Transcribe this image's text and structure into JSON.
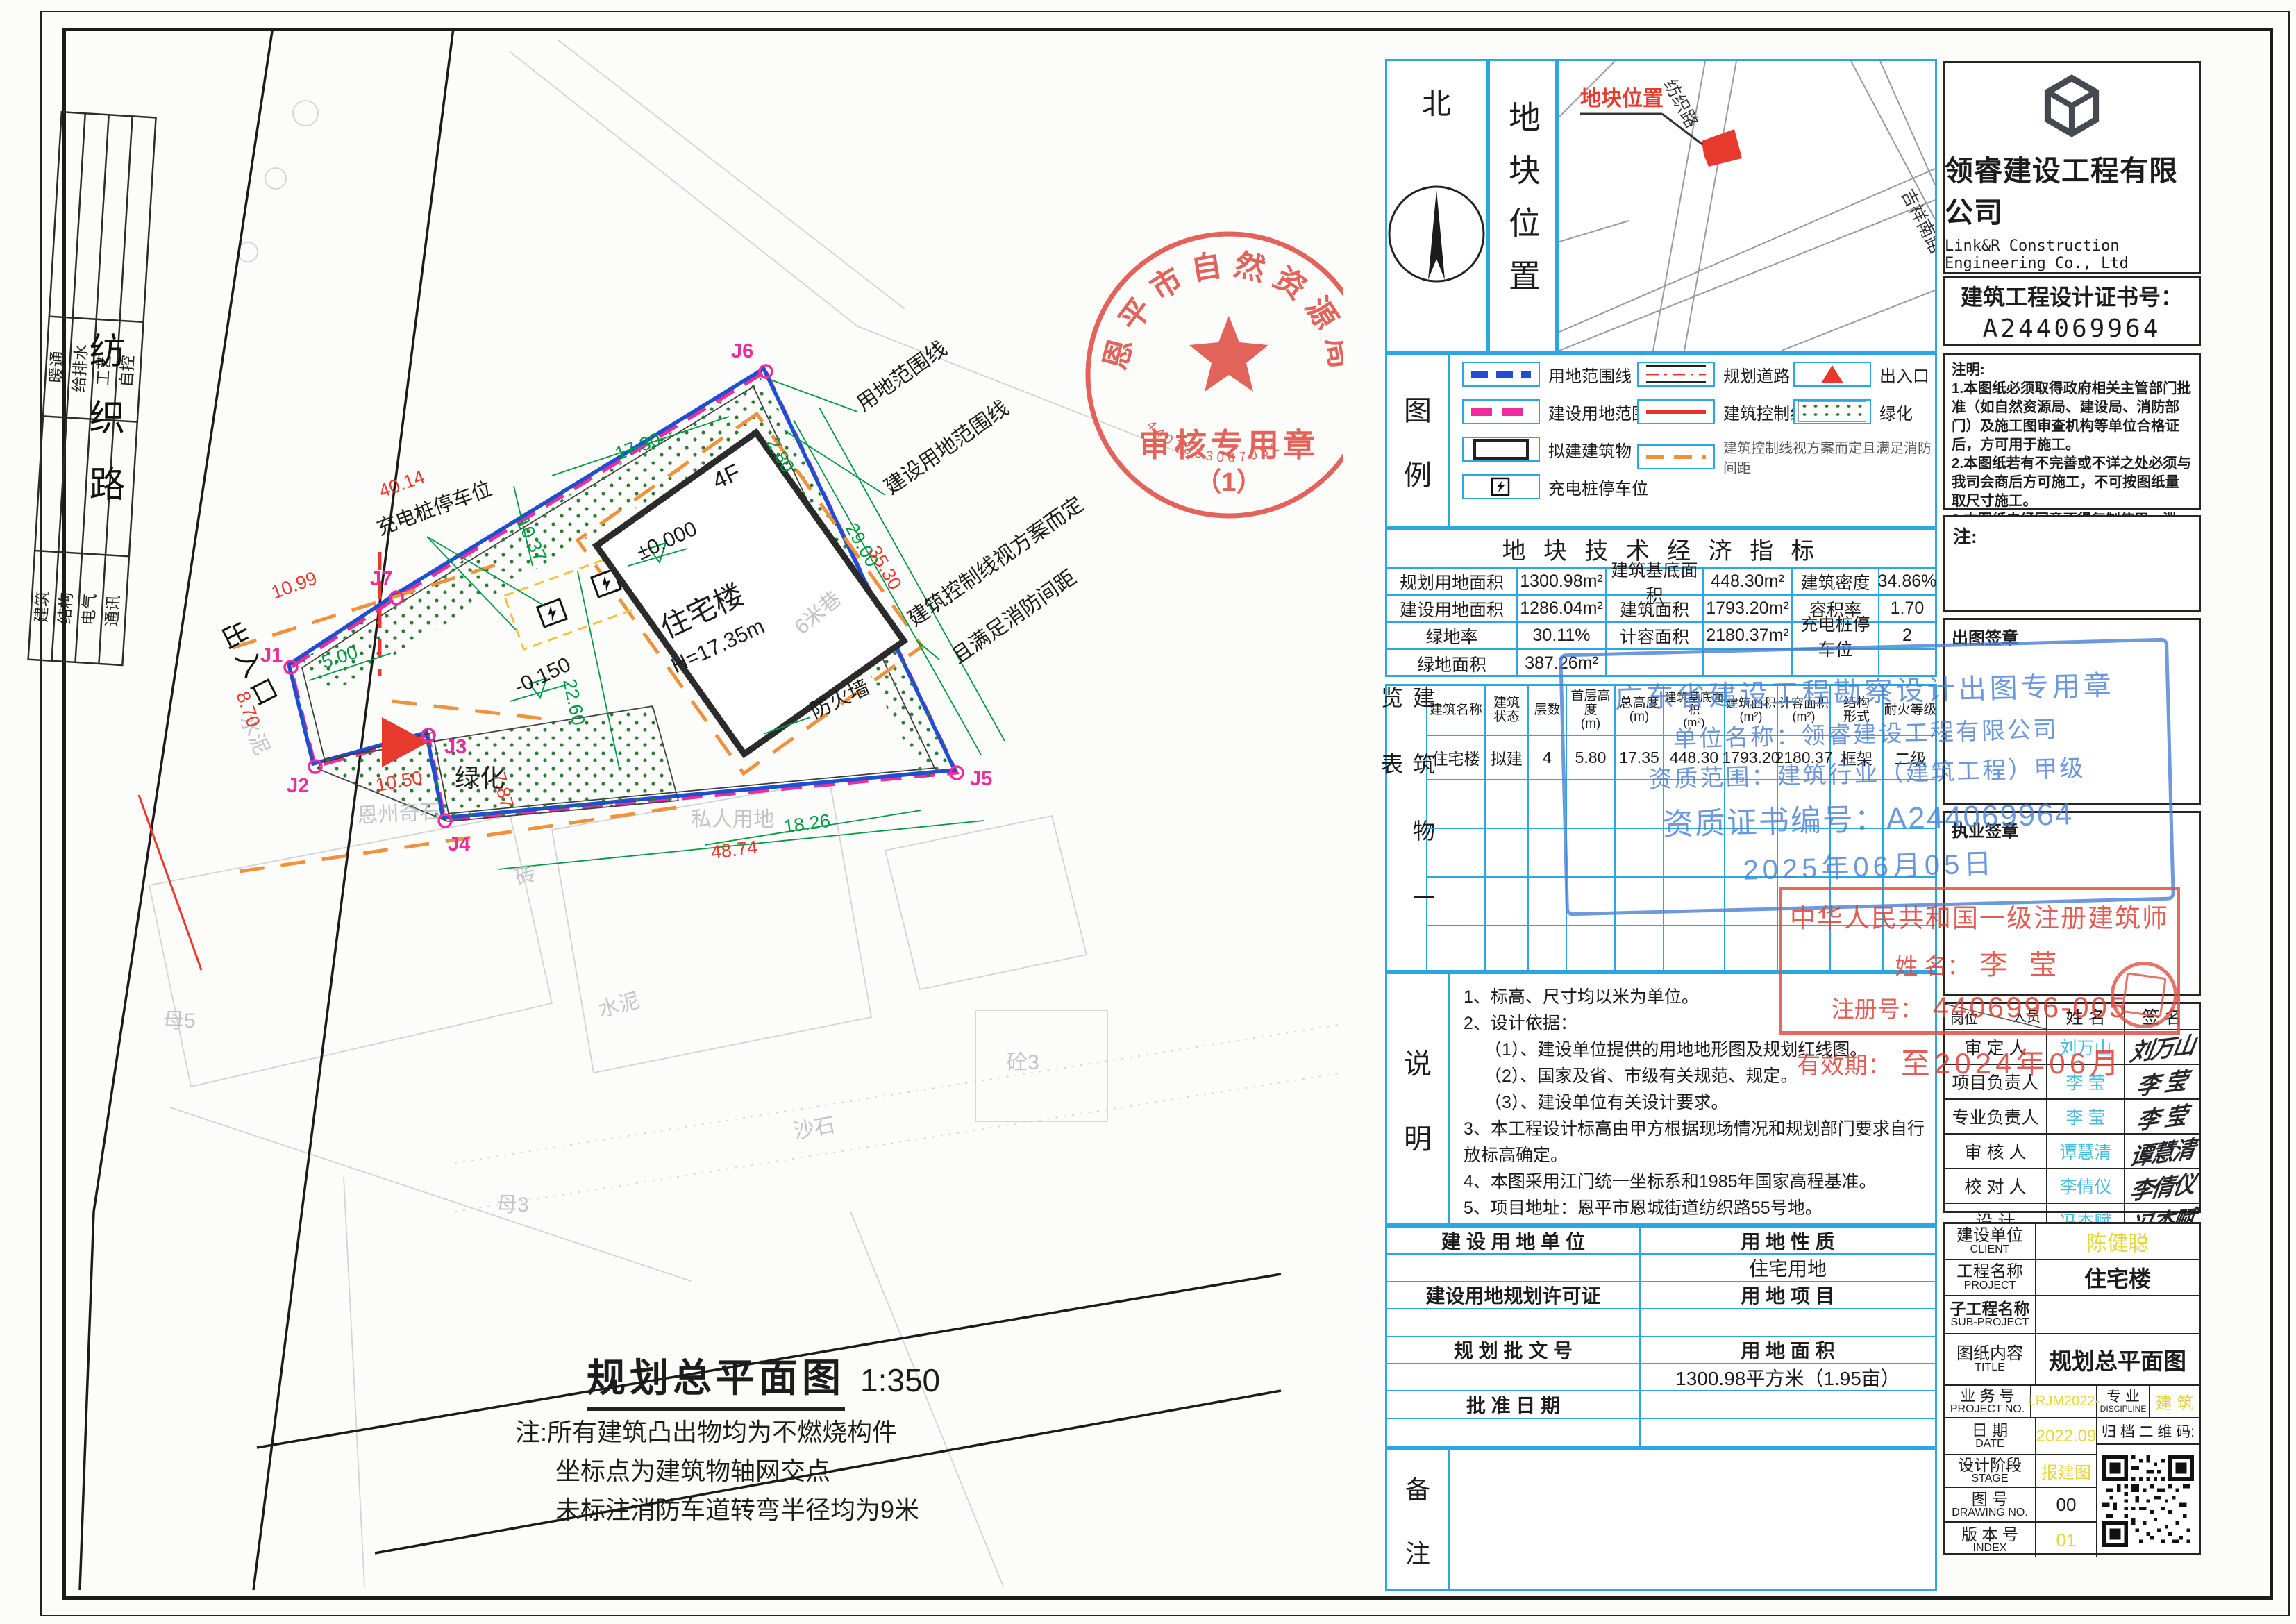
{
  "plan": {
    "road_name": "纺织路",
    "entrance_text": "出入口",
    "labels": {
      "use_boundary": "用地范围线",
      "constr_boundary": "建设用地范围线",
      "control1": "建筑控制线视方案而定",
      "control2": "且满足消防间距",
      "charging": "充电桩停车位",
      "greenery": "绿化",
      "firewall": "防火墙",
      "private_land": "私人用地",
      "cement": "水泥",
      "cement2": "水泥",
      "brick": "砖",
      "gravel": "沙石",
      "concrete": "砼3",
      "enzhou": "恩州奇石",
      "lane": "6米巷",
      "plot5": "母5",
      "plot3": "母3"
    },
    "building": {
      "name": "住宅楼",
      "height": "H=17.35m",
      "floors": "4F",
      "level0": "±0.000",
      "level1": "-0.150"
    },
    "points": {
      "j1": "J1",
      "j2": "J2",
      "j3": "J3",
      "j4": "J4",
      "j5": "J5",
      "j6": "J6",
      "j7": "J7"
    },
    "dims": {
      "d40": "40.14",
      "d1099": "10.99",
      "d870": "8.70",
      "d500": "5.00",
      "d1050": "10.50",
      "d787": "7.87",
      "d4874": "48.74",
      "d1826": "18.26",
      "d1730": "17.30",
      "d2260": "22.60",
      "d2900": "29.00",
      "d3530": "35.30",
      "d280": "2.80",
      "d1037": "10.37"
    },
    "stamp": {
      "org": "恩平市自然资源局",
      "line2": "审核专用章",
      "line3": "（1）",
      "serial": "4407853007031"
    },
    "caption": {
      "title": "规划总平面图",
      "scale": "1:350",
      "note1": "注:所有建筑凸出物均为不燃烧构件",
      "note2": "坐标点为建筑物轴网交点",
      "note3": "未标注消防车道转弯半径均为9米"
    }
  },
  "signbar": {
    "d1": "暖通",
    "d2": "给排水",
    "d3": "工艺",
    "d4": "自控",
    "d5": "建筑",
    "d6": "结构",
    "d7": "电气",
    "d8": "通讯"
  },
  "panel": {
    "north": "北",
    "location_title": "地块位置",
    "map": {
      "marker": "地块位置",
      "road1": "纺织路",
      "road2": "吉祥南路"
    },
    "legend": {
      "t1": "图",
      "t2": "例",
      "items": [
        "用地范围线",
        "规划道路",
        "出入口",
        "建设用地范围线",
        "建筑控制线",
        "绿化",
        "拟建建筑物",
        "建筑控制线视方案而定且满足消防间距",
        "充电桩停车位"
      ]
    },
    "indicators": {
      "title": "地 块  技 术 经 济 指 标",
      "rows": [
        [
          "规划用地面积",
          "1300.98m²",
          "建筑基底面积",
          "448.30m²",
          "建筑密度",
          "34.86%"
        ],
        [
          "建设用地面积",
          "1286.04m²",
          "建筑面积",
          "1793.20m²",
          "容积率",
          "1.70"
        ],
        [
          "绿地率",
          "30.11%",
          "计容面积",
          "2180.37m²",
          "充电桩停车位",
          "2"
        ],
        [
          "绿地面积",
          "387.26m²",
          "",
          "",
          "",
          ""
        ]
      ]
    },
    "btable": {
      "side": "建 筑 物 一 览 表",
      "headers": [
        [
          "建筑名称",
          ""
        ],
        [
          "建筑",
          "状态"
        ],
        [
          "层数",
          ""
        ],
        [
          "首层高度",
          "(m)"
        ],
        [
          "总高度",
          "(m)"
        ],
        [
          "建筑基底面积",
          "(m²)"
        ],
        [
          "建筑面积",
          "(m²)"
        ],
        [
          "计容面积",
          "(m²)"
        ],
        [
          "结构",
          "形式"
        ],
        [
          "耐火等级",
          ""
        ]
      ],
      "row": [
        "住宅楼",
        "拟建",
        "4",
        "5.80",
        "17.35",
        "448.30",
        "1793.20",
        "2180.37",
        "框架",
        "二级"
      ]
    },
    "notes": {
      "side1": "说",
      "side2": "明",
      "lines": [
        "1、标高、尺寸均以米为单位。",
        "2、设计依据：",
        "（1）、建设单位提供的用地地形图及规划红线图。",
        "（2）、国家及省、市级有关规范、规定。",
        "（3）、建设单位有关设计要求。",
        "3、本工程设计标高由甲方根据现场情况和规划部门要求自行放标高确定。",
        "4、本图采用江门统一坐标系和1985年国家高程基准。",
        "5、项目地址：恩平市恩城街道纺织路55号地。",
        "6、本次报建内容：住宅楼"
      ]
    },
    "landuse": {
      "l1": "建 设 用 地 单 位",
      "r1": "用 地 性 质",
      "r2": "住宅用地",
      "l3": "建设用地规划许可证",
      "r3": "用 地 项 目",
      "l5": "规 划 批 文 号",
      "r5": "用 地 面 积",
      "r6": "1300.98平方米（1.95亩）",
      "l7": "批 准 日 期",
      "remark1": "备",
      "remark2": "注"
    }
  },
  "tb": {
    "company": "领睿建设工程有限公司",
    "company_en": "Link&R Construction Engineering Co., Ltd",
    "cert_label": "建筑工程设计证书号：",
    "cert_no": "A244069964",
    "remarks_title": "注明:",
    "remarks": [
      "1.本图纸必须取得政府相关主管部门批准（如自然资源局、建设局、消防部门）及施工图审查机构等单位合格证后，方可用于施工。",
      "2.本图纸若有不完善或不详之处必须与我司会商后方可施工，不可按图纸量取尺寸施工。",
      "3.本图纸未经同意不得复制使用、泄露、散布。",
      "4.本图纸须加盖出图签章、执业签章及二维码,否则一律无效。"
    ],
    "note_label": "注:",
    "chop_label": "出图签章",
    "chop": {
      "l0": "广东省建设工程勘察设计出图专用章",
      "l1": "单位名称：领睿建设工程有限公司",
      "l2": "资质范围：建筑行业（建筑工程）甲级",
      "l3": "资质证书编号：A244069964",
      "l4": "2025年06月05日"
    },
    "lic_label": "执业签章",
    "lic": {
      "l0": "中华人民共和国一级注册建筑师",
      "name_l": "姓  名：",
      "name": "李  莹",
      "reg_l": "注册号：",
      "reg": "4406996-005",
      "valid_l": "有效期：",
      "valid": "至2024年06月"
    },
    "signoff": {
      "h1": "岗位",
      "h2": "人员",
      "h3": "姓  名",
      "h4": "签  名",
      "rows": [
        [
          "审 定 人",
          "刘万山"
        ],
        [
          "项目负责人",
          "李 莹"
        ],
        [
          "专业负责人",
          "李 莹"
        ],
        [
          "审 核 人",
          "谭慧清"
        ],
        [
          "校 对 人",
          "李倩仪"
        ],
        [
          "设  计",
          "冯杰赋"
        ]
      ]
    },
    "info": {
      "client_l": "建设单位",
      "client_e": "CLIENT",
      "client": "陈健聪",
      "proj_l": "工程名称",
      "proj_e": "PROJECT",
      "proj": "住宅楼",
      "sub_l": "子工程名称",
      "sub_e": "SUB-PROJECT",
      "sub": "",
      "title_l": "图纸内容",
      "title_e": "TITLE",
      "title": "规划总平面图",
      "no_l": "业 务 号",
      "no_e": "PROJECT NO.",
      "no": "LRJM2022-",
      "disc_l": "专  业",
      "disc_e": "DISCIPLINE",
      "disc": "建  筑",
      "date_l": "日  期",
      "date_e": "DATE",
      "date": "2022.09",
      "qr_l": "归 档 二 维 码:",
      "stage_l": "设计阶段",
      "stage_e": "STAGE",
      "stage": "报建图",
      "dno_l": "图  号",
      "dno_e": "DRAWING NO.",
      "dno": "00",
      "idx_l": "版 本 号",
      "idx_e": "INDEX",
      "idx": "01"
    }
  }
}
